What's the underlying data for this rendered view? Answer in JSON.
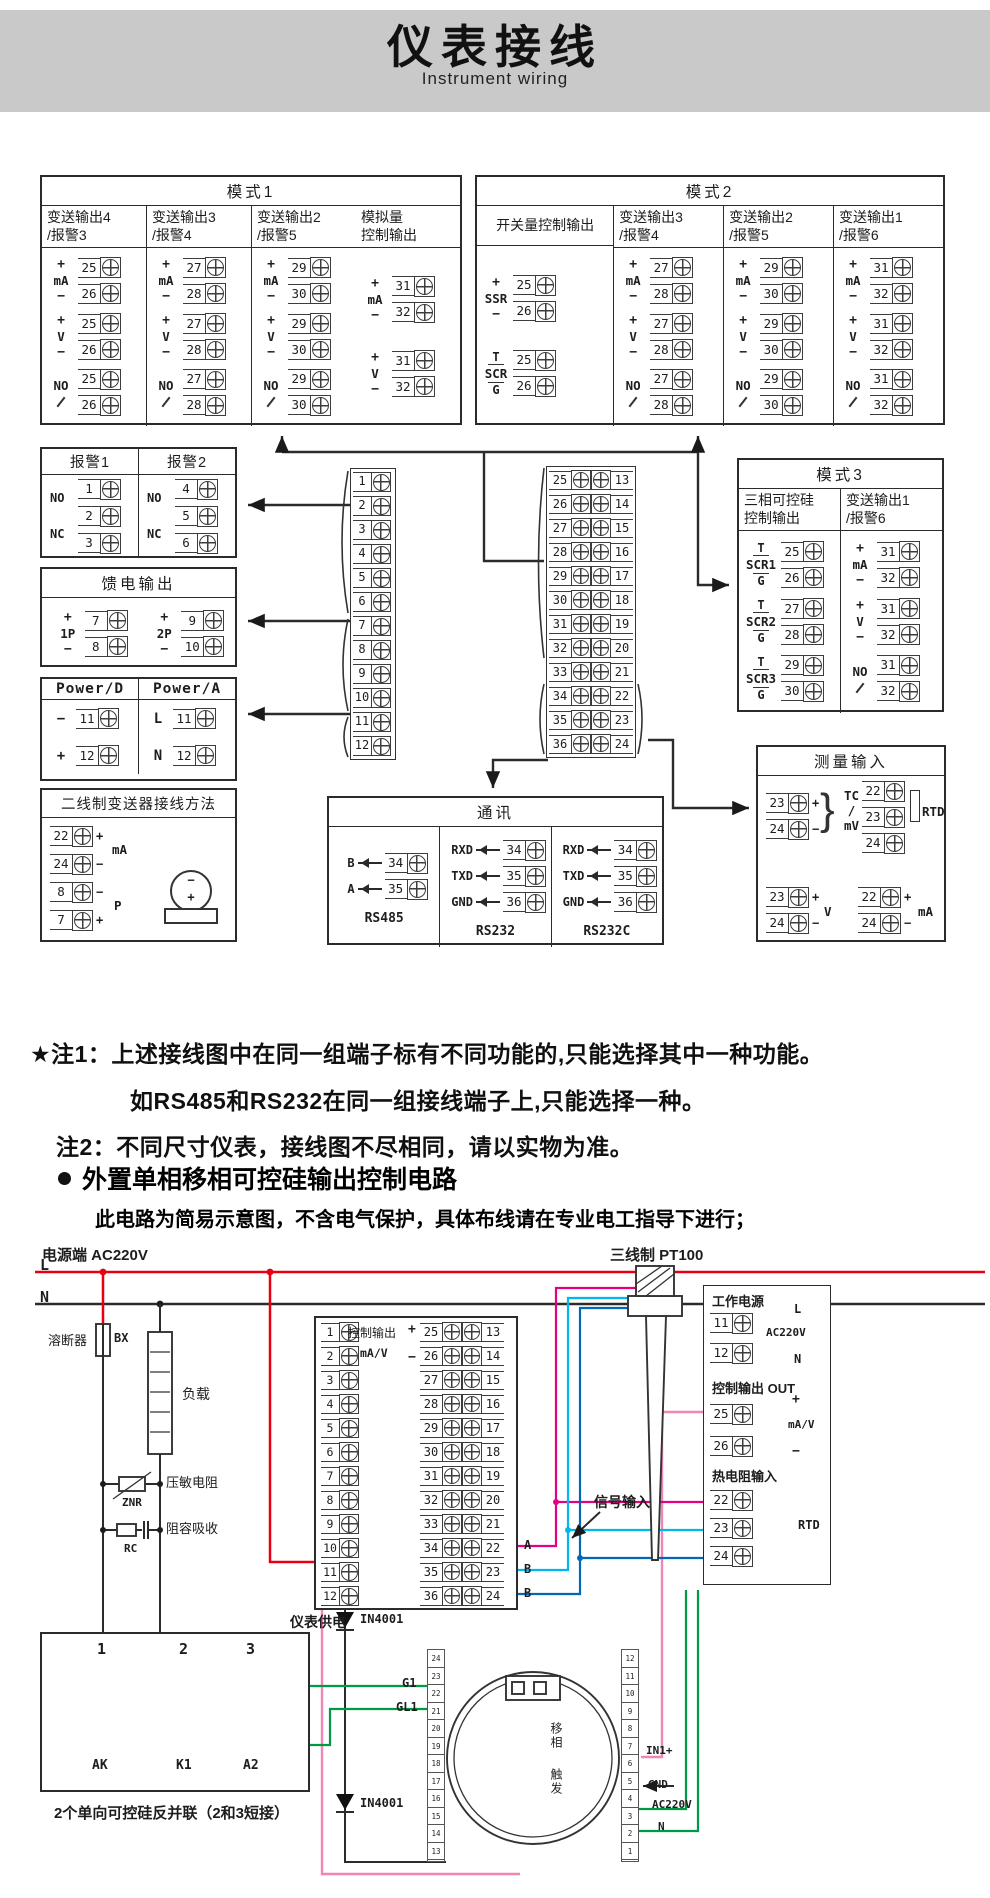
{
  "header": {
    "title": "仪表接线",
    "subtitle": "Instrument wiring"
  },
  "labels": {
    "ma": "mA",
    "v": "V",
    "no": "NO",
    "ssr": "SSR",
    "scr": "SCR",
    "t": "T",
    "g": "G",
    "plus": "+",
    "minus": "−"
  },
  "mode1": {
    "title": "模式1",
    "main_cols": [
      {
        "h1": "变送输出4",
        "h2": "/报警3",
        "a": "25",
        "b": "26"
      },
      {
        "h1": "变送输出3",
        "h2": "/报警4",
        "a": "27",
        "b": "28"
      },
      {
        "h1": "变送输出2",
        "h2": "/报警5",
        "a": "29",
        "b": "30"
      }
    ],
    "last_col": {
      "h1": "模拟量",
      "h2": "控制输出",
      "a": "31",
      "b": "32"
    }
  },
  "mode2": {
    "title": "模式2",
    "first_col": {
      "h": "开关量控制输出",
      "a": "25",
      "b": "26"
    },
    "main_cols": [
      {
        "h1": "变送输出3",
        "h2": "/报警4",
        "a": "27",
        "b": "28"
      },
      {
        "h1": "变送输出2",
        "h2": "/报警5",
        "a": "29",
        "b": "30"
      },
      {
        "h1": "变送输出1",
        "h2": "/报警6",
        "a": "31",
        "b": "32"
      }
    ]
  },
  "mode3": {
    "title": "模式3",
    "col1": {
      "h1": "三相可控硅",
      "h2": "控制输出",
      "groups": [
        {
          "name": "SCR1",
          "a": "25",
          "b": "26"
        },
        {
          "name": "SCR2",
          "a": "27",
          "b": "28"
        },
        {
          "name": "SCR3",
          "a": "29",
          "b": "30"
        }
      ]
    },
    "col2": {
      "h1": "变送输出1",
      "h2": "/报警6",
      "a": "31",
      "b": "32"
    }
  },
  "alarm": {
    "t1": "报警1",
    "t2": "报警2",
    "no": "NO",
    "nc": "NC",
    "g1": [
      "1",
      "2",
      "3"
    ],
    "g2": [
      "4",
      "5",
      "6"
    ]
  },
  "feed": {
    "title": "馈电输出",
    "groups": [
      {
        "name": "1P",
        "a": "7",
        "b": "8"
      },
      {
        "name": "2P",
        "a": "9",
        "b": "10"
      }
    ]
  },
  "power": {
    "t1": "Power/D",
    "t2": "Power/A",
    "rows1": [
      {
        "s": "−",
        "n": "11"
      },
      {
        "s": "+",
        "n": "12"
      }
    ],
    "rows2": [
      {
        "s": "L",
        "n": "11"
      },
      {
        "s": "N",
        "n": "12"
      }
    ]
  },
  "twowire": {
    "title": "二线制变送器接线方法",
    "rows": [
      {
        "n": "22",
        "s": "+"
      },
      {
        "n": "24",
        "s": "−"
      },
      {
        "n": "8",
        "s": "−"
      },
      {
        "n": "7",
        "s": "+"
      }
    ],
    "mid1": "mA",
    "mid2": "P",
    "tx1": "−",
    "tx2": "+"
  },
  "center": {
    "left": [
      "1",
      "2",
      "3",
      "4",
      "5",
      "6",
      "7",
      "8",
      "9",
      "10",
      "11",
      "12"
    ],
    "mid": [
      "25",
      "26",
      "27",
      "28",
      "29",
      "30",
      "31",
      "32",
      "33",
      "34",
      "35",
      "36"
    ],
    "right": [
      "13",
      "14",
      "15",
      "16",
      "17",
      "18",
      "19",
      "20",
      "21",
      "22",
      "23",
      "24"
    ]
  },
  "comm": {
    "title": "通讯",
    "g0": {
      "name": "RS485",
      "rows": [
        {
          "s": "B",
          "n": "34"
        },
        {
          "s": "A",
          "n": "35"
        }
      ]
    },
    "g1": {
      "name": "RS232",
      "rows": [
        {
          "s": "RXD",
          "n": "34"
        },
        {
          "s": "TXD",
          "n": "35"
        },
        {
          "s": "GND",
          "n": "36"
        }
      ]
    },
    "g2": {
      "name": "RS232C",
      "rows": [
        {
          "s": "RXD",
          "n": "34"
        },
        {
          "s": "TXD",
          "n": "35"
        },
        {
          "s": "GND",
          "n": "36"
        }
      ]
    }
  },
  "measure": {
    "title": "测量输入",
    "tc": {
      "rows": [
        {
          "n": "23",
          "s": "+"
        },
        {
          "n": "24",
          "s": "−"
        }
      ],
      "l1": "TC",
      "l2": "/",
      "l3": "mV"
    },
    "rtd": {
      "t": [
        "22",
        "23",
        "24"
      ],
      "label": "RTD"
    },
    "v": {
      "rows": [
        {
          "n": "23",
          "s": "+"
        },
        {
          "n": "24",
          "s": "−"
        }
      ],
      "label": "V"
    },
    "ma": {
      "rows": [
        {
          "n": "22",
          "s": "+"
        },
        {
          "n": "24",
          "s": "−"
        }
      ],
      "label": "mA"
    }
  },
  "notes": {
    "n1": "★注1：上述接线图中在同一组端子标有不同功能的,只能选择其中一种功能。",
    "n2": "如RS485和RS232在同一组接线端子上,只能选择一种。",
    "n3": "注2：不同尺寸仪表，接线图不尽相同，请以实物为准。"
  },
  "section2": {
    "title": "外置单相移相可控硅输出控制电路",
    "note": "此电路为简易示意图，不含电气保护，具体布线请在专业电工指导下进行；"
  },
  "circuit": {
    "power_label": "电源端 AC220V",
    "l": "L",
    "n": "N",
    "fuse": "溶断器",
    "fuse_code": "BX",
    "load": "负载",
    "varistor": "压敏电阻",
    "varistor_code": "ZNR",
    "rc": "阻容吸收",
    "rc_code": "RC",
    "ctrl": {
      "label": "控制输出",
      "plus": "+",
      "mav": "mA/V",
      "minus": "−"
    },
    "strip": {
      "left": [
        "1",
        "2",
        "3",
        "4",
        "5",
        "6",
        "7",
        "8",
        "9",
        "10",
        "11",
        "12"
      ],
      "mid": [
        "25",
        "26",
        "27",
        "28",
        "29",
        "30",
        "31",
        "32",
        "33",
        "34",
        "35",
        "36"
      ],
      "right": [
        "13",
        "14",
        "15",
        "16",
        "17",
        "18",
        "19",
        "20",
        "21",
        "22",
        "23",
        "24"
      ]
    },
    "sig_tags": [
      "A",
      "B",
      "B"
    ],
    "signal_label": "信号输入",
    "pt100": "三线制 PT100",
    "panel": {
      "p1": "工作电源",
      "p1_rows": [
        {
          "n": "11",
          "s": "L"
        },
        {
          "n": "12",
          "s": "N"
        }
      ],
      "p1_note": "AC220V",
      "p2": "控制输出 OUT",
      "p2_rows": [
        {
          "n": "25",
          "s": "+"
        },
        {
          "n": "26",
          "s": "−"
        }
      ],
      "p2_note": "mA/V",
      "p3": "热电阻输入",
      "p3_rows": [
        "22",
        "23",
        "24"
      ],
      "p3_note": "RTD"
    },
    "meter_supply": "仪表供电",
    "diode": "IN4001",
    "scrbox": {
      "nums": [
        "1",
        "2",
        "3"
      ],
      "labels": [
        "AK",
        "K1",
        "A2"
      ],
      "caption": "2个单向可控硅反并联（2和3短接）"
    },
    "trigger": {
      "left_strip": [
        "24",
        "23",
        "22",
        "21",
        "20",
        "19",
        "18",
        "17",
        "16",
        "15",
        "14",
        "13"
      ],
      "right_strip": [
        "12",
        "11",
        "10",
        "9",
        "8",
        "7",
        "6",
        "5",
        "4",
        "3",
        "2",
        "1"
      ],
      "g1": "G1",
      "gl1": "GL1",
      "ini": "IN1+",
      "gnd": "GND",
      "ac": "AC220V",
      "n": "N",
      "v1": "移相",
      "v2": "触发"
    }
  },
  "colors": {
    "band": "#c9c9c9",
    "line": "#2b2b2b",
    "red": "#e60012",
    "green": "#009944",
    "magenta": "#e4007f",
    "cyan": "#00b7ee",
    "blue": "#0068b7",
    "pink": "#ef86b5"
  }
}
